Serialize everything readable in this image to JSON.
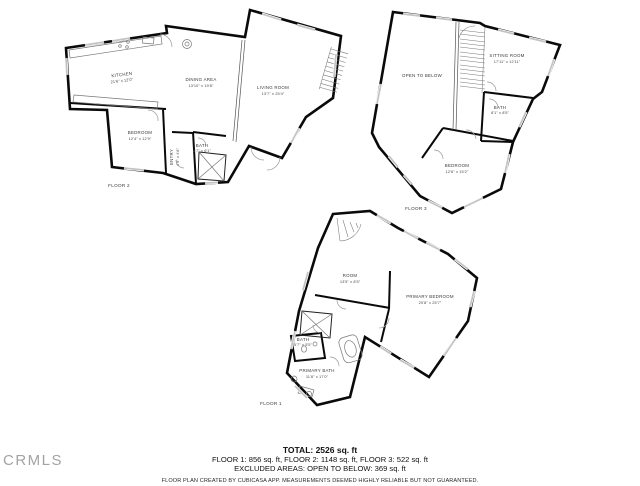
{
  "branding": {
    "logo": "CRMLS"
  },
  "floors": [
    {
      "name": "FLOOR 2",
      "rooms": [
        {
          "label": "KITCHEN",
          "dims": "21'6\" x 12'0\""
        },
        {
          "label": "DINING AREA",
          "dims": "13'10\" x 19'8\""
        },
        {
          "label": "LIVING ROOM",
          "dims": "13'7\" x 25'4\""
        },
        {
          "label": "BEDROOM",
          "dims": "12'4\" x 12'9\""
        },
        {
          "label": "ENTRY",
          "dims": "4'9\" x 4'8\""
        },
        {
          "label": "BATH",
          "dims": "6'7\" x 6'1\""
        }
      ]
    },
    {
      "name": "FLOOR 3",
      "rooms": [
        {
          "label": "OPEN TO BELOW",
          "dims": ""
        },
        {
          "label": "SITTING ROOM",
          "dims": "17'11\" x 12'11\""
        },
        {
          "label": "BATH",
          "dims": "8'1\" x 8'5\""
        },
        {
          "label": "BEDROOM",
          "dims": "12'6\" x 15'2\""
        }
      ]
    },
    {
      "name": "FLOOR 1",
      "rooms": [
        {
          "label": "ROOM",
          "dims": "13'5\" x 8'5\""
        },
        {
          "label": "PRIMARY BEDROOM",
          "dims": "20'8\" x 25'7\""
        },
        {
          "label": "BATH",
          "dims": "5'7\" x 5'5\""
        },
        {
          "label": "PRIMARY BATH",
          "dims": "11'8\" x 17'0\""
        }
      ]
    }
  ],
  "summary": {
    "total": "TOTAL: 2526 sq. ft",
    "floors_line": "FLOOR 1: 856 sq. ft, FLOOR 2: 1148 sq. ft, FLOOR 3: 522 sq. ft",
    "excluded_line": "EXCLUDED AREAS: OPEN TO BELOW: 369 sq. ft",
    "disclaimer": "FLOOR PLAN CREATED BY CUBICASA APP. MEASUREMENTS DEEMED HIGHLY RELIABLE BUT NOT GUARANTEED."
  }
}
